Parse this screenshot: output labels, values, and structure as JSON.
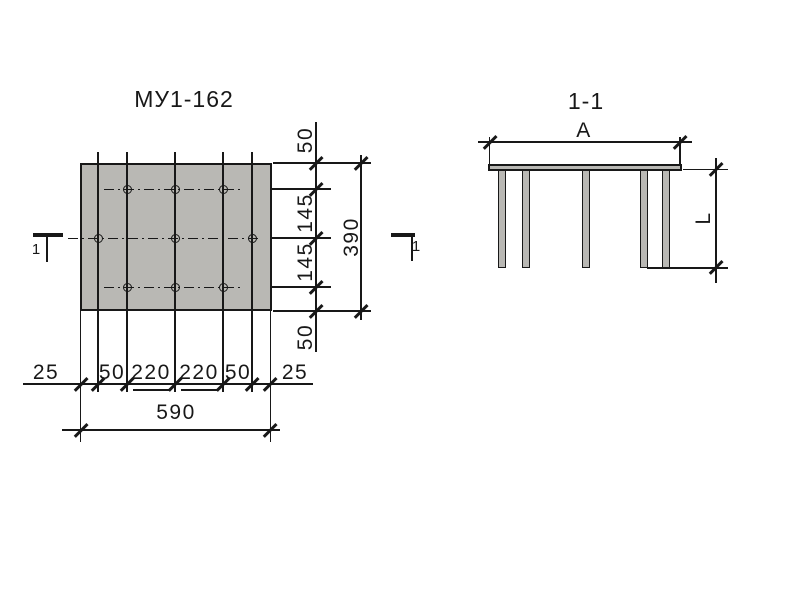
{
  "plan": {
    "title": "МУ1-162",
    "section_cut_label": "1",
    "hole_count": 9,
    "bottom_chain": {
      "segments": [
        "25",
        "50",
        "220",
        "220",
        "50",
        "25"
      ],
      "total": "590"
    },
    "right_chain": {
      "segments": [
        "50",
        "145",
        "145",
        "50"
      ],
      "total": "390"
    }
  },
  "section": {
    "title": "1-1",
    "width_label": "A",
    "length_label": "L",
    "leg_count": 5
  },
  "colors": {
    "plate_fill": "#b9b8b4",
    "line": "#181818",
    "background": "#ffffff"
  }
}
